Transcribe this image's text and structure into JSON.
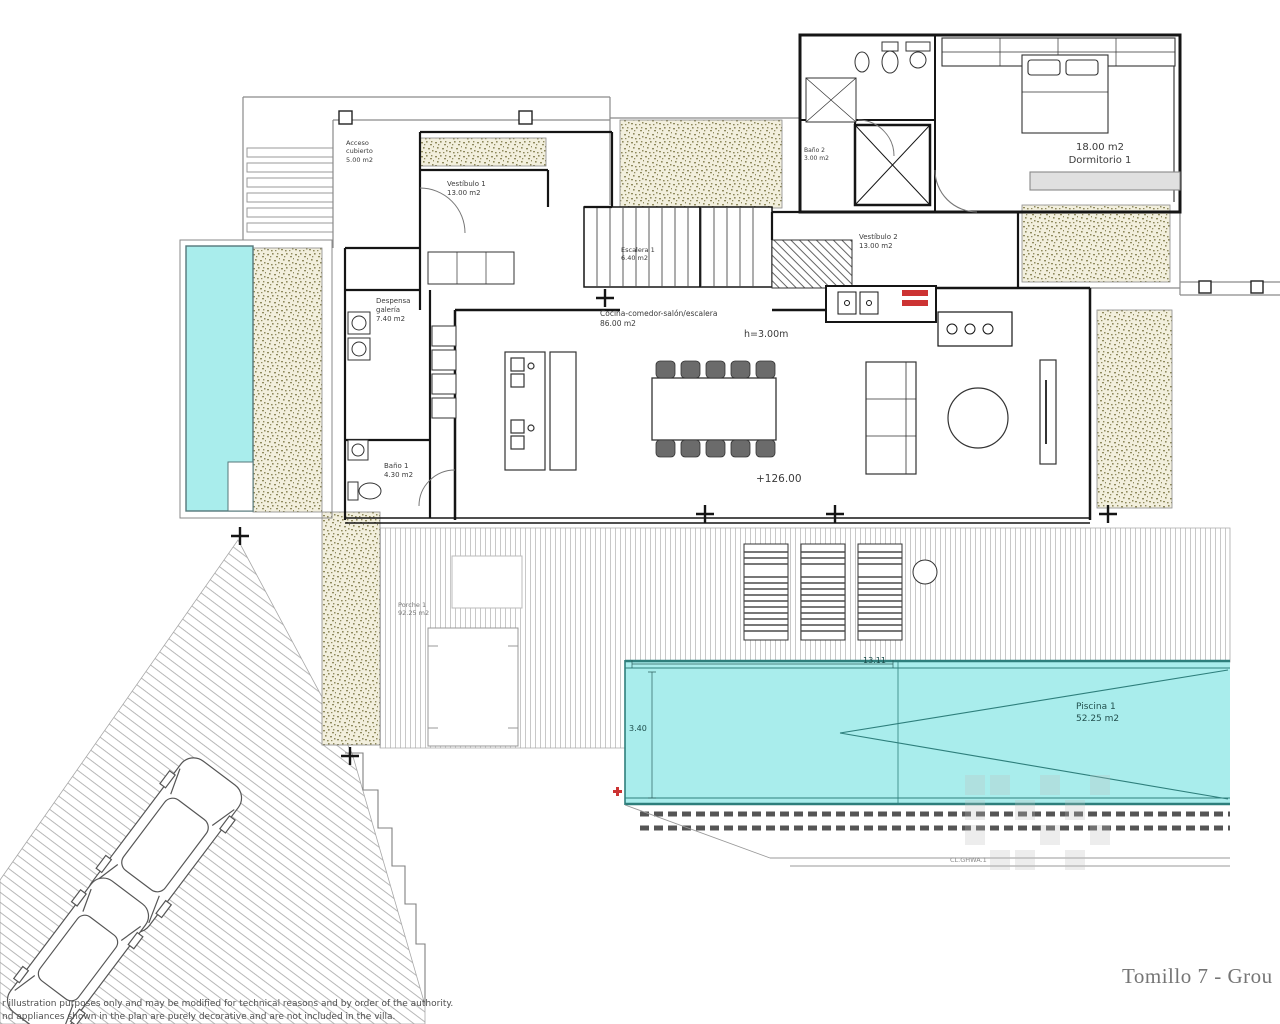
{
  "drawing": {
    "title": "Tomillo 7 - Grou",
    "disclaimer_line1": "r illustration purposes only and may be modified for technical reasons and by order of the authority.",
    "disclaimer_line2": "nd appliances shown in the plan are purely decorative and are not included in the villa."
  },
  "rooms": {
    "acceso": {
      "l1": "Acceso",
      "l2": "cubierto",
      "l3": "5.00 m2"
    },
    "vestibulo1": {
      "l1": "Vestíbulo 1",
      "l2": "13.00 m2"
    },
    "despensa": {
      "l1": "Despensa",
      "l2": "galería",
      "l3": "7.40 m2"
    },
    "bano1": {
      "l1": "Baño 1",
      "l2": "4.30 m2"
    },
    "escalera1": {
      "l1": "Escalera 1",
      "l2": "6.40 m2"
    },
    "cocina_salon": {
      "l1": "Cocina-comedor-salón/escalera",
      "l2": "86.00 m2"
    },
    "vestibulo2": {
      "l1": "Vestíbulo 2",
      "l2": "13.00 m2"
    },
    "bano2": {
      "l1": "Baño 2",
      "l2": "3.00 m2"
    },
    "dormitorio1": {
      "l1": "18.00 m2",
      "l2": "Dormitorio 1"
    },
    "porche1": {
      "l1": "Porche 1",
      "l2": "92.25 m2"
    },
    "piscina1": {
      "l1": "Piscina 1",
      "l2": "52.25 m2"
    }
  },
  "annotations": {
    "ceiling_height": "h=3.00m",
    "floor_level": "+126.00",
    "pool_length": "13.11",
    "pool_width": "3.40",
    "plan_code": "CL.GHWA.1"
  },
  "colors": {
    "pool_fill": "#a9edec",
    "pool_edge": "#2e7f7c",
    "planter_speckle": "#8f8a5d",
    "wall": "#151515",
    "accent_red": "#cc3333"
  }
}
